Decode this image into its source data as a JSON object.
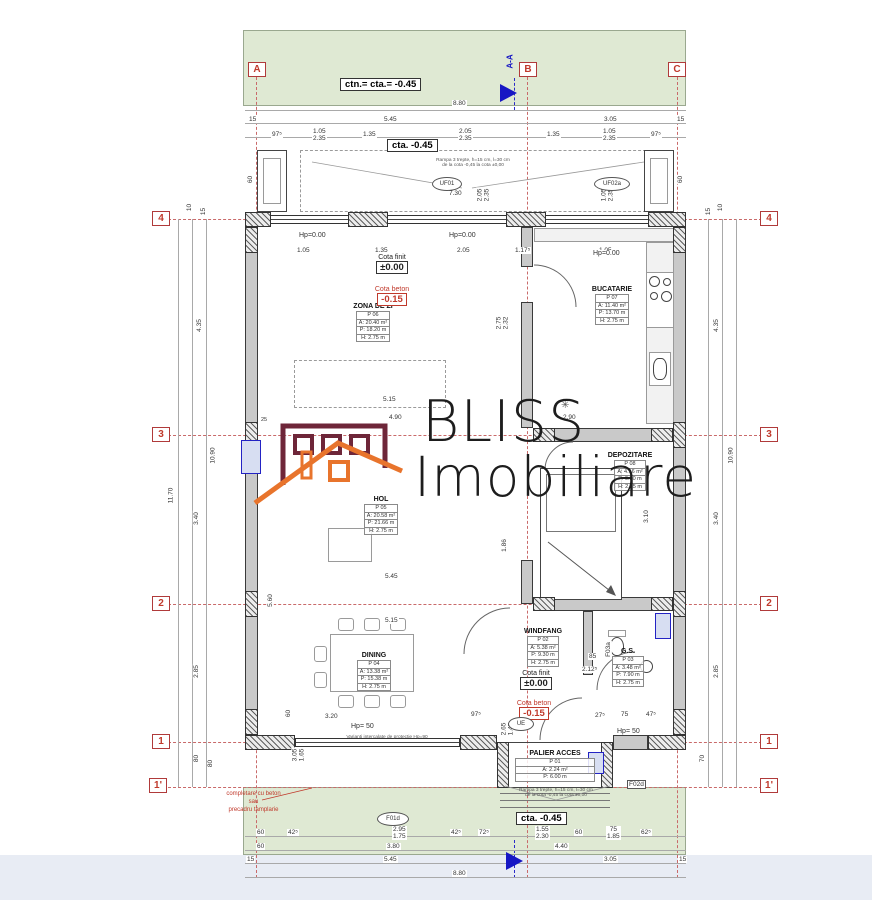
{
  "watermark": {
    "line1": "BLISS",
    "line2": "Imobiliare",
    "building_color": "#6e2639",
    "roof_color": "#e8742c"
  },
  "levels": {
    "ctn_top": "ctn.= cta.= -0.45",
    "cta_top": "cta. -0.45",
    "cta_bottom": "cta. -0.45",
    "cota_finit_label": "Cota finit",
    "cota_finit_value": "±0.00",
    "cota_beton_label": "Cota beton",
    "cota_beton_value": "-0.15"
  },
  "grid": {
    "cols": [
      "A",
      "B",
      "C"
    ],
    "rows": [
      "4",
      "3",
      "2",
      "1",
      "1'"
    ],
    "section": "A-A"
  },
  "rooms": {
    "zona": {
      "name": "ZONA DE ZI",
      "no": "P 06",
      "a": "A: 20.40 m²",
      "p": "P: 18.20 m",
      "h": "H: 2.75 m"
    },
    "bucatarie": {
      "name": "BUCATARIE",
      "no": "P 07",
      "a": "A: 11.40 m²",
      "p": "P: 13.70 m",
      "h": "H: 2.75 m"
    },
    "depozitare": {
      "name": "DEPOZITARE",
      "no": "P 08",
      "a": "A: 4.16 m²",
      "p": "P: 9.80 m",
      "h": "H: 2.75 m"
    },
    "hol": {
      "name": "HOL",
      "no": "P 05",
      "a": "A: 20.58 m²",
      "p": "P: 21.66 m",
      "h": "H: 2.75 m"
    },
    "dining": {
      "name": "DINING",
      "no": "P 04",
      "a": "A: 13.38 m²",
      "p": "P: 15.38 m",
      "h": "H: 2.75 m"
    },
    "windfang": {
      "name": "WINDFANG",
      "no": "P 02",
      "a": "A: 5.38 m²",
      "p": "P: 9.30 m",
      "h": "H: 2.75 m"
    },
    "gs": {
      "name": "G.S.",
      "no": "P 03",
      "a": "A: 3.48 m²",
      "p": "P: 7.90 m",
      "h": "H: 2.75 m"
    },
    "palier": {
      "name": "PALIER ACCES",
      "no": "P 01",
      "a": "A: 2.24 m²",
      "p": "P: 6.00 m"
    }
  },
  "labels": {
    "hp000": "Hp=0.00",
    "hp50": "Hp= 50",
    "ramp1": "Rampa 3 trepte, h=15 cm, l=30 cm",
    "ramp2": "de la cota -0,45 la cota ±0,00",
    "note_red1": "completare cu beton",
    "note_red2": "sau",
    "note_red3": "precadru tamplarie",
    "window_note": "Varianti intercalate de protectie Hp=90"
  },
  "openings": {
    "uf01": "UF01",
    "uf02a": "UF02a",
    "f01d": "F01d",
    "f02d": "F02d",
    "f03a": "F03a",
    "ue": "UE"
  },
  "dims": {
    "top1": "8.80",
    "top2": [
      "15",
      "5.45",
      "3.05",
      "15"
    ],
    "top3": [
      "97⁵",
      "1.05",
      "2.35",
      "1.35",
      "2.05",
      "2.35",
      "1.35",
      "1.05",
      "2.35",
      "97⁵"
    ],
    "top730": "7.30",
    "toprot1": [
      "2.05",
      "2.35"
    ],
    "toprot2": [
      "1.05",
      "2.35"
    ],
    "innertop": [
      "1.05",
      "1.35",
      "2.05",
      "1.17⁵",
      "1.05"
    ],
    "bay60": "60",
    "bottom1": [
      "60",
      "42⁵",
      "2.95",
      "1.75",
      "42⁵",
      "72⁵",
      "1.55",
      "2.30",
      "60",
      "75",
      "1.85",
      "62⁵"
    ],
    "bottom2": [
      "60",
      "3.80",
      "4.40"
    ],
    "bottom3": [
      "15",
      "5.45",
      "3.05",
      "15"
    ],
    "bottom4": "8.80",
    "left": [
      "10",
      "15",
      "4.35",
      "11.70",
      "10.90",
      "3.40",
      "2.85",
      "80",
      "80"
    ],
    "right": [
      "10",
      "15",
      "4.35",
      "10.90",
      "3.40",
      "2.85",
      "70",
      "3.10"
    ],
    "interior": [
      "5.15",
      "4.90",
      "2.90",
      "25",
      "5.45",
      "5.60",
      "1.86",
      "5.15",
      "3.20",
      "97⁵",
      "1.65",
      "27⁵",
      "75",
      "47⁵",
      "85",
      "2.12⁵",
      "2.75",
      "2.32",
      "60",
      "2.65",
      "1.45",
      "3.05",
      "1.65"
    ]
  }
}
